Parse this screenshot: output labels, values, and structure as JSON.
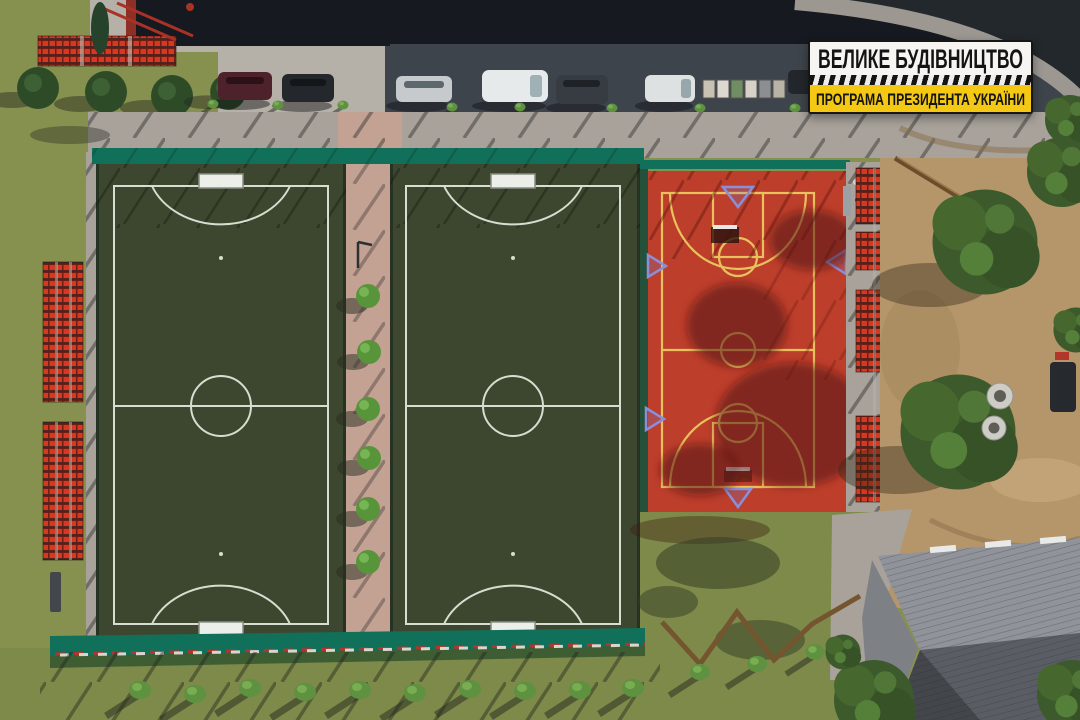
{
  "badge": {
    "line1": "ВЕЛИКЕ БУДІВНИЦТВО",
    "line2": "ПРОГРАМА ПРЕЗИДЕНТА УКРАЇНИ"
  },
  "colors": {
    "turf": "#3d462e",
    "field_line": "#d8ddd1",
    "court": "#bc3e2b",
    "court_line": "#e9c25d",
    "fence": "#11705a",
    "grass": "#87914f",
    "grass_south": "#7d8a4a",
    "sand": "#b5966b",
    "asphalt": "#3e444b",
    "roof_strip": "#16191f",
    "sidewalk": "#a8a29b",
    "concrete": "#b6b1a8",
    "path": "#c3a193",
    "bleacher": "#d8381f",
    "roof_light": "#90949a",
    "roof_dark": "#5a5e64",
    "badge_bg": "#f6f5f1",
    "badge_yellow": "#f5c913",
    "badge_text": "#141414"
  }
}
